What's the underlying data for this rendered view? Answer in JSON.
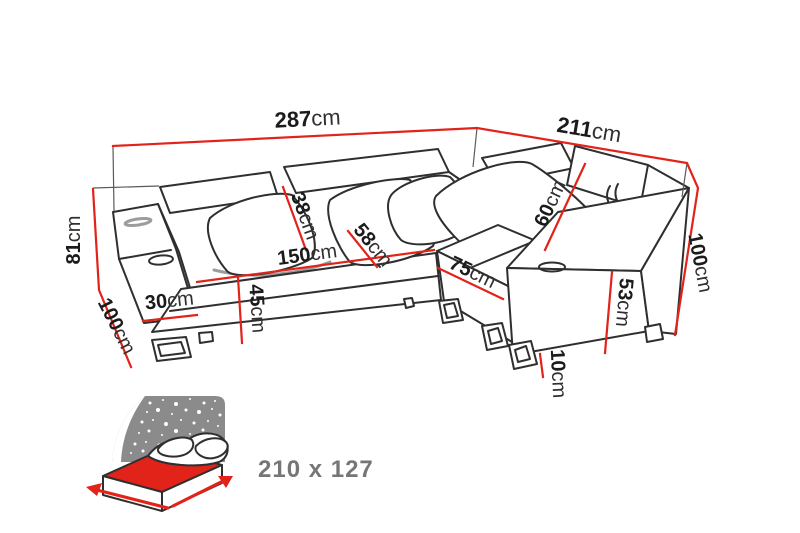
{
  "diagram": {
    "type": "corner-sofa dimension drawing",
    "dimensions": {
      "total_width": {
        "value": "287",
        "unit": "cm"
      },
      "right_width": {
        "value": "211",
        "unit": "cm"
      },
      "back_height": {
        "value": "81",
        "unit": "cm"
      },
      "left_depth": {
        "value": "100",
        "unit": "cm"
      },
      "backrest_height": {
        "value": "38",
        "unit": "cm"
      },
      "seat_depth": {
        "value": "58",
        "unit": "cm"
      },
      "seat_width": {
        "value": "150",
        "unit": "cm"
      },
      "armrest_width": {
        "value": "30",
        "unit": "cm"
      },
      "seat_height": {
        "value": "45",
        "unit": "cm"
      },
      "chaise_width": {
        "value": "75",
        "unit": "cm"
      },
      "headrest_diag": {
        "value": "60",
        "unit": "cm"
      },
      "armrest_height": {
        "value": "53",
        "unit": "cm"
      },
      "right_depth": {
        "value": "100",
        "unit": "cm"
      },
      "leg_height": {
        "value": "10",
        "unit": "cm"
      }
    },
    "sleeping_area": {
      "label": "210 x 127"
    },
    "colors": {
      "dimension_line": "#e2231a",
      "sketch": "#2f2f2f",
      "icon_background": "#8b8b8b",
      "icon_mattress": "#e2231a",
      "caption": "#767676"
    }
  }
}
